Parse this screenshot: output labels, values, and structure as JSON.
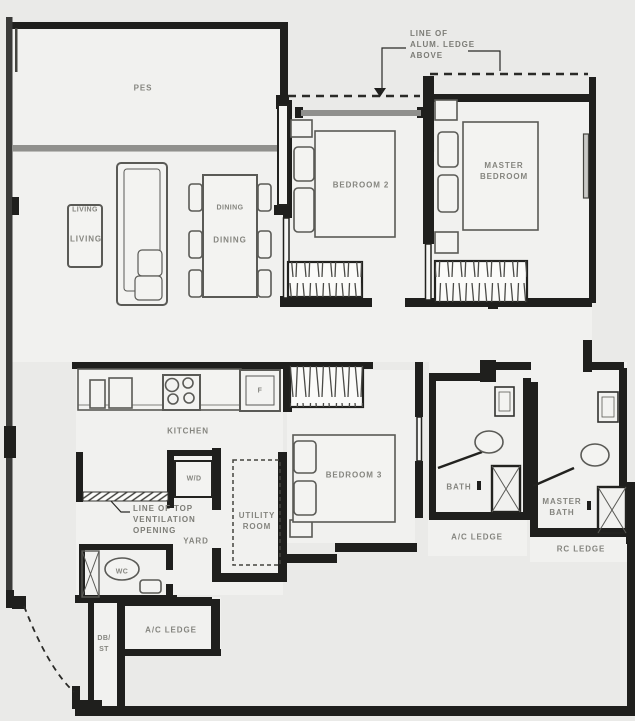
{
  "drawing": {
    "type": "residential floor plan",
    "labels": {
      "pes": "PES",
      "living_1": "LIVING",
      "living_2": "LIVING",
      "dining_1": "DINING",
      "dining_2": "DINING",
      "bedroom2": "BEDROOM 2",
      "master_bedroom_l1": "MASTER",
      "master_bedroom_l2": "BEDROOM",
      "kitchen": "KITCHEN",
      "fridge": "F",
      "washer_dryer": "W/D",
      "bedroom3": "BEDROOM 3",
      "utility_l1": "UTILITY",
      "utility_l2": "ROOM",
      "yard": "YARD",
      "wc": "WC",
      "bath": "BATH",
      "master_bath_l1": "MASTER",
      "master_bath_l2": "BATH",
      "ac_ledge_bath": "A/C LEDGE",
      "rc_ledge": "RC LEDGE",
      "ac_ledge_bottom": "A/C LEDGE",
      "db_st_l1": "DB/",
      "db_st_l2": "ST"
    },
    "annotations": {
      "alum_ledge_l1": "LINE OF",
      "alum_ledge_l2": "ALUM. LEDGE",
      "alum_ledge_l3": "ABOVE",
      "vent_l1": "LINE OF TOP",
      "vent_l2": "VENTILATION",
      "vent_l3": "OPENING"
    },
    "colors": {
      "wall": "#1f1f1d",
      "window_band": "#90908d",
      "floor": "#f1f1ef",
      "furniture_line": "#5a5a56",
      "label_text": "#85857f"
    }
  }
}
